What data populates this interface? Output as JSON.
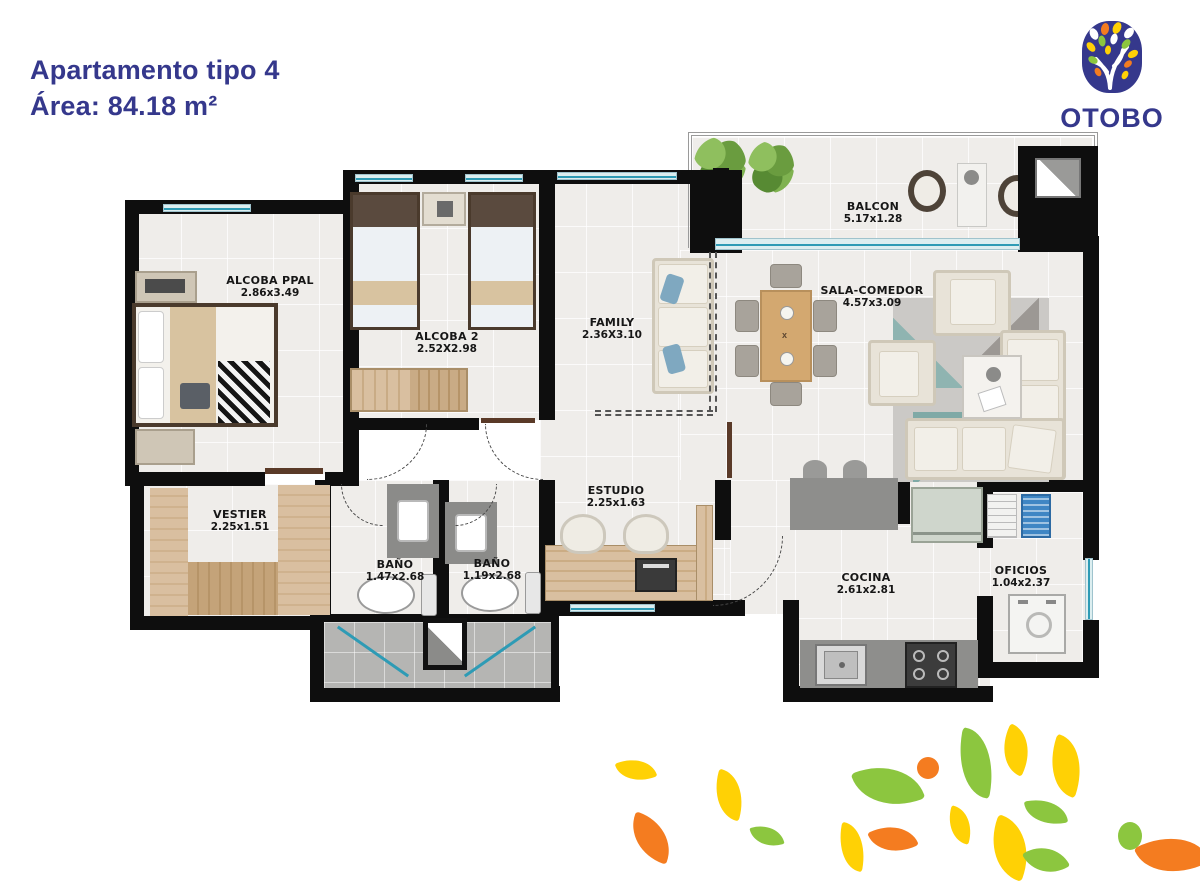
{
  "header": {
    "title": "Apartamento tipo 4",
    "area_label": "Área: 84.18 m²"
  },
  "logo": {
    "brand": "OTOBO"
  },
  "rooms": [
    {
      "id": "alcoba-ppal",
      "name": "ALCOBA PPAL",
      "dims": "2.86x3.49"
    },
    {
      "id": "alcoba-2",
      "name": "ALCOBA 2",
      "dims": "2.52X2.98"
    },
    {
      "id": "family",
      "name": "FAMILY",
      "dims": "2.36X3.10"
    },
    {
      "id": "sala-comedor",
      "name": "SALA-COMEDOR",
      "dims": "4.57x3.09"
    },
    {
      "id": "balcon",
      "name": "BALCON",
      "dims": "5.17x1.28"
    },
    {
      "id": "vestier",
      "name": "VESTIER",
      "dims": "2.25x1.51"
    },
    {
      "id": "bano-1",
      "name": "BAÑO",
      "dims": "1.47x2.68"
    },
    {
      "id": "bano-2",
      "name": "BAÑO",
      "dims": "1.19x2.68"
    },
    {
      "id": "estudio",
      "name": "ESTUDIO",
      "dims": "2.25x1.63"
    },
    {
      "id": "cocina",
      "name": "COCINA",
      "dims": "2.61x2.81"
    },
    {
      "id": "oficios",
      "name": "OFICIOS",
      "dims": "1.04x2.37"
    }
  ],
  "colors": {
    "brand_navy": "#35388C",
    "leaf_yellow": "#FFD105",
    "leaf_green": "#8CC63F",
    "leaf_orange": "#F47C20",
    "window_teal": "#2E9BB5",
    "wall_black": "#0E0E0E"
  }
}
